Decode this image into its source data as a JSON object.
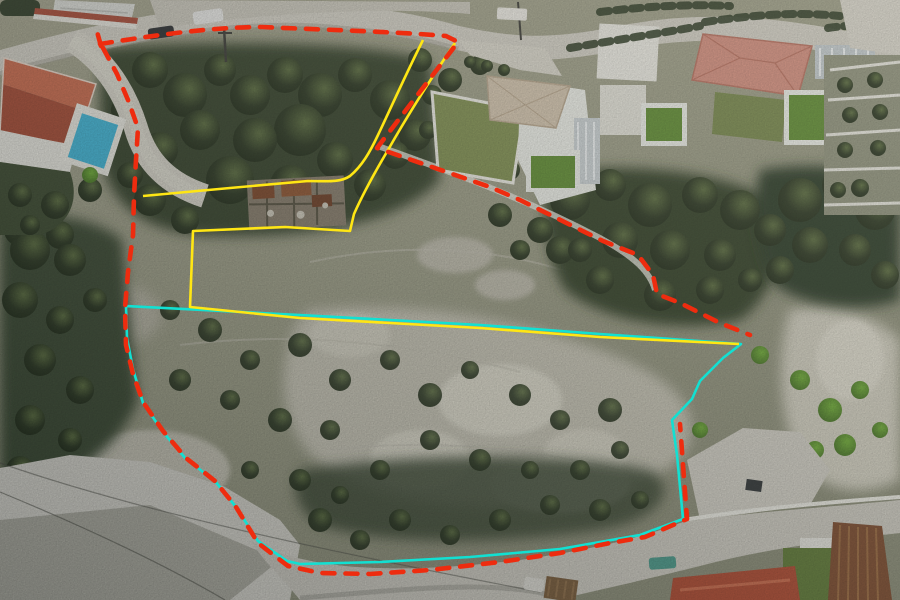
{
  "meta": {
    "type": "aerial-drone-photo",
    "width": 900,
    "height": 600,
    "description": "Aerial view of a rocky hillside building plot between two roads, with villas at top, a stone ruin, and surveyor boundary overlays"
  },
  "overlays": {
    "outer_boundary": {
      "label": "outer plot boundary",
      "style": "dashed",
      "color": "#ee2c0f"
    },
    "parcel_outline": {
      "label": "inner parcel outline",
      "style": "solid",
      "color": "#12e0d2"
    },
    "access_corridor": {
      "label": "access corridor and inner lines",
      "style": "solid",
      "color": "#ffe614"
    }
  },
  "scene": {
    "roads": [
      {
        "name": "top-road",
        "surface": "#d2cfc5"
      },
      {
        "name": "parking-area",
        "surface": "#d6d4cb"
      },
      {
        "name": "bottom-road",
        "surface": "#cfccc2"
      },
      {
        "name": "side-road",
        "surface": "#d3d0c6"
      }
    ],
    "buildings": [
      {
        "name": "villa-topleft",
        "roof": "#a64a33",
        "pool": "#3fb6d8"
      },
      {
        "name": "villa-a",
        "roof": "#d3c4ae",
        "lawn": "#7f8f4f",
        "pool": "#5e8c30"
      },
      {
        "name": "villa-mid",
        "pool": "#5e8c30"
      },
      {
        "name": "villa-b",
        "roof": "#d48d7d",
        "lawn": "#76874a",
        "pool": "#5e8c30"
      },
      {
        "name": "ruin",
        "walls": "#877c6b"
      },
      {
        "name": "red-roof-house",
        "roof": "#b0492f"
      },
      {
        "name": "rusty-roof-shed",
        "roof": "#7d4a2c"
      }
    ],
    "vehicles": [
      {
        "name": "white-van",
        "color": "#e8e8e6"
      },
      {
        "name": "dark-car",
        "color": "#2a2d30"
      },
      {
        "name": "white-truck",
        "color": "#eceae4"
      },
      {
        "name": "teal-car",
        "color": "#4a9a8a"
      },
      {
        "name": "white-car",
        "color": "#dedcd4"
      }
    ]
  }
}
